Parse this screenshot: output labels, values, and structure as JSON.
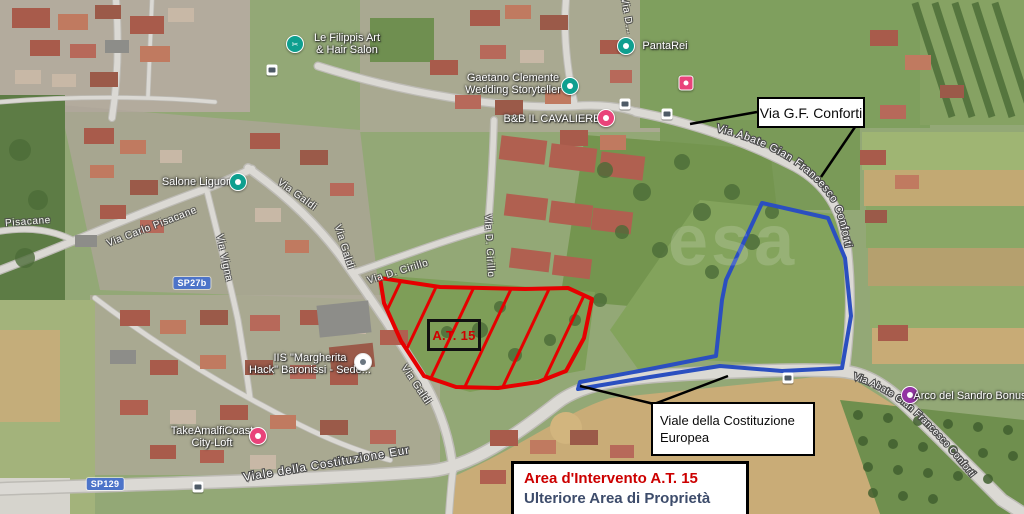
{
  "annotations": {
    "conforti_box": "Via G.F. Conforti",
    "viale_line1": "Viale della Costituzione",
    "viale_line2": "Europea",
    "at15": "A.T. 15",
    "legend": {
      "item1": "Area d'Intervento A.T. 15",
      "item2": "Ulteriore Area di Proprietà",
      "item1_color": "#cc0000",
      "item2_color": "#3d4c6b"
    },
    "area_colors": {
      "intervention_outline": "#e60000",
      "property_outline": "#2b4fc0"
    }
  },
  "map": {
    "watermark": "esa",
    "badges": [
      {
        "label": "SP27b"
      },
      {
        "label": "SP129"
      }
    ],
    "poi": [
      {
        "line1": "Le Filippis Art",
        "line2": "& Hair Salon"
      },
      {
        "line1": "PantaRei",
        "line2": ""
      },
      {
        "line1": "Gaetano Clemente",
        "line2": "Wedding Storyteller"
      },
      {
        "line1": "B&B IL CAVALIERE",
        "line2": ""
      },
      {
        "line1": "Salone Liguori",
        "line2": ""
      },
      {
        "line1": "IIS \"Margherita",
        "line2": "Hack\" Baronissi - Sede..."
      },
      {
        "line1": "TakeAmalfiCoast",
        "line2": "City-Loft"
      },
      {
        "line1": "Arco del Sandro Bonus",
        "line2": ""
      }
    ],
    "roads": [
      {
        "label": "Pisacane"
      },
      {
        "label": "Via Carlo Pisacane"
      },
      {
        "label": "Via Vigna"
      },
      {
        "label": "Via Galdi"
      },
      {
        "label": "Via Galdi"
      },
      {
        "label": "Via Galdi"
      },
      {
        "label": "Via D. Cirillo"
      },
      {
        "label": "Via D. Cirillo"
      },
      {
        "label": "Via D..."
      },
      {
        "label": "Via Abate Gian Francesco Conforti"
      },
      {
        "label": "Via Abate Gian Francesco Conforti"
      },
      {
        "label": "Viale della Costituzione Europea"
      }
    ]
  }
}
